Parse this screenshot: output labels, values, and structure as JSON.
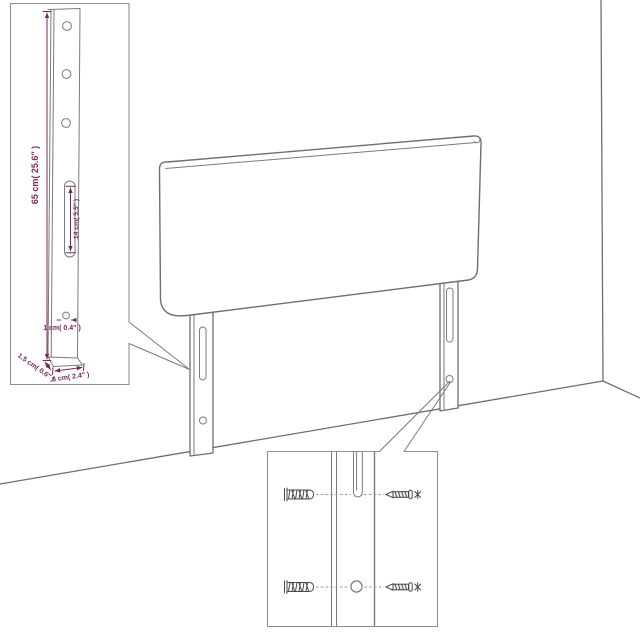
{
  "image": {
    "type": "product-assembly-dimension-diagram",
    "subject": "upholstered headboard with two mounting legs against a room corner",
    "background": "#ffffff"
  },
  "colors": {
    "outline": "#6e6e6e",
    "dimension": "#78285a",
    "inset_border": "#8f8f8f",
    "hardware": "#4a4a4a"
  },
  "leg_inset": {
    "title": "leg-dimension-detail",
    "labels": {
      "height": "65 cm( 25.6″ )",
      "slot_height": "14 cm( 5.5″ )",
      "hole_diameter": "1 cm( 0.4″ )",
      "depth": "1.5 cm( 0.6″ )",
      "width": "6 cm( 2.4″ )"
    },
    "features": [
      "three-holes",
      "keyhole-slot",
      "bottom-hole"
    ]
  },
  "mount_inset": {
    "title": "wall-mounting-detail",
    "icons": [
      "wall-plug-icon",
      "screw-icon",
      "keyhole-slot",
      "round-hole"
    ],
    "rows": 2
  }
}
